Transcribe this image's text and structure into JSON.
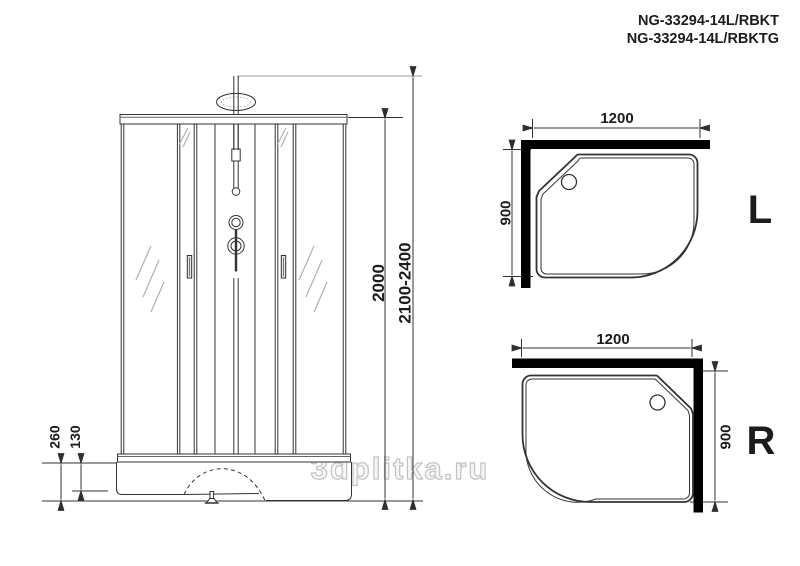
{
  "title": {
    "line1": "NG-33294-14L/RBKT",
    "line2": "NG-33294-14L/RBKTG"
  },
  "watermark": "3dplitka.ru",
  "front_view": {
    "dims": {
      "height_inner": "2000",
      "height_total": "2100-2400",
      "base_height": "260",
      "base_step": "130"
    }
  },
  "tray_views": {
    "left": {
      "label": "L",
      "width": "1200",
      "depth": "900"
    },
    "right": {
      "label": "R",
      "width": "1200",
      "depth": "900"
    }
  },
  "colors": {
    "line": "#333333",
    "bar": "#000000",
    "hatch": "#b0b0b0",
    "watermark_outline": "#c3c3c3"
  }
}
